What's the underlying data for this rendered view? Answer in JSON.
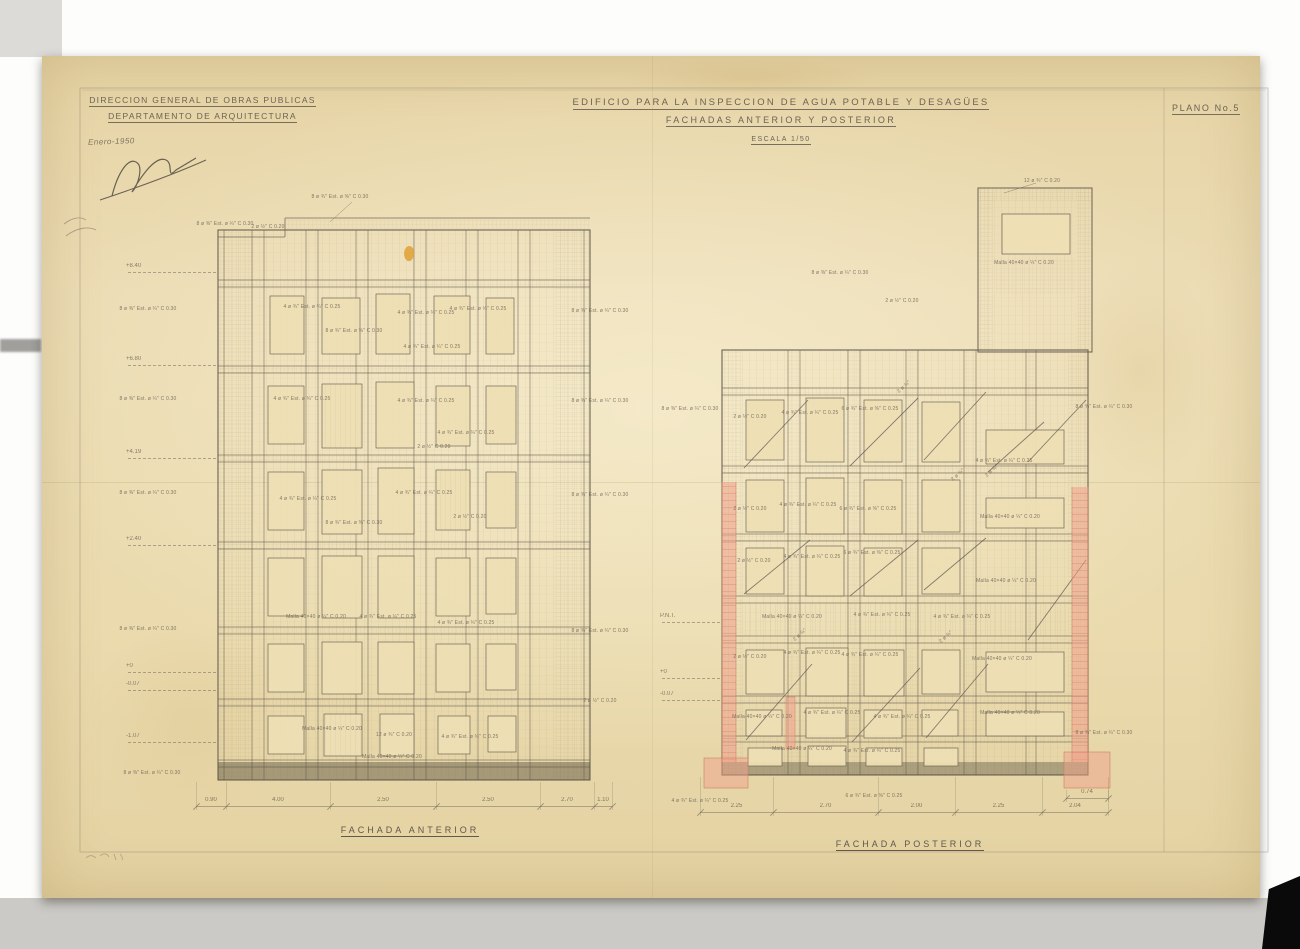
{
  "header": {
    "org_line1": "DIRECCION GENERAL DE OBRAS PUBLICAS",
    "org_line2": "DEPARTAMENTO DE ARQUITECTURA",
    "date": "Enero-1950",
    "title_line1": "EDIFICIO PARA LA INSPECCION DE AGUA POTABLE Y DESAGÜES",
    "title_line2": "FACHADAS ANTERIOR Y POSTERIOR",
    "scale": "ESCALA 1/50",
    "plano": "PLANO No.5"
  },
  "facades": {
    "anterior": {
      "label": "FACHADA ANTERIOR",
      "elevations": [
        "+8.40",
        "+6.80",
        "+4.19",
        "+2.40",
        "+0",
        "-0.07",
        "-1.07"
      ],
      "dimensions": [
        "0.90",
        "4.00",
        "2.50",
        "2.50",
        "2.70",
        "1.10"
      ]
    },
    "posterior": {
      "label": "FACHADA POSTERIOR",
      "datum_marks": [
        "P.N.T.",
        "+0",
        "-0.07"
      ],
      "dimensions": [
        "2.25",
        "2.70",
        "2.00",
        "2.25",
        "2.04"
      ],
      "footing_dim": "0.74"
    }
  },
  "callouts": {
    "a": "8 ø ⅜″ Est. ø ¼″ C 0.30",
    "b": "4 ø ¾″ Est. ø ¼″ C 0.25",
    "c": "8 ø ¾″ Est. ø ⅜″ C 0.30",
    "d": "2 ø ½″ C 0.20",
    "e": "Malla 40×40 ø ¼″ C 0.20",
    "f": "12 ø ¾″ C 0.20",
    "g": "6 ø ¾″ Est. ø ⅜″ C 0.25",
    "brace": "2 ø ¾″"
  },
  "colors": {
    "paper": "#eadaad",
    "pencil": "#6b6355",
    "red_wash": "#f0a18c",
    "red_line": "#cf7d64",
    "stain_yellow": "#dfa133"
  }
}
